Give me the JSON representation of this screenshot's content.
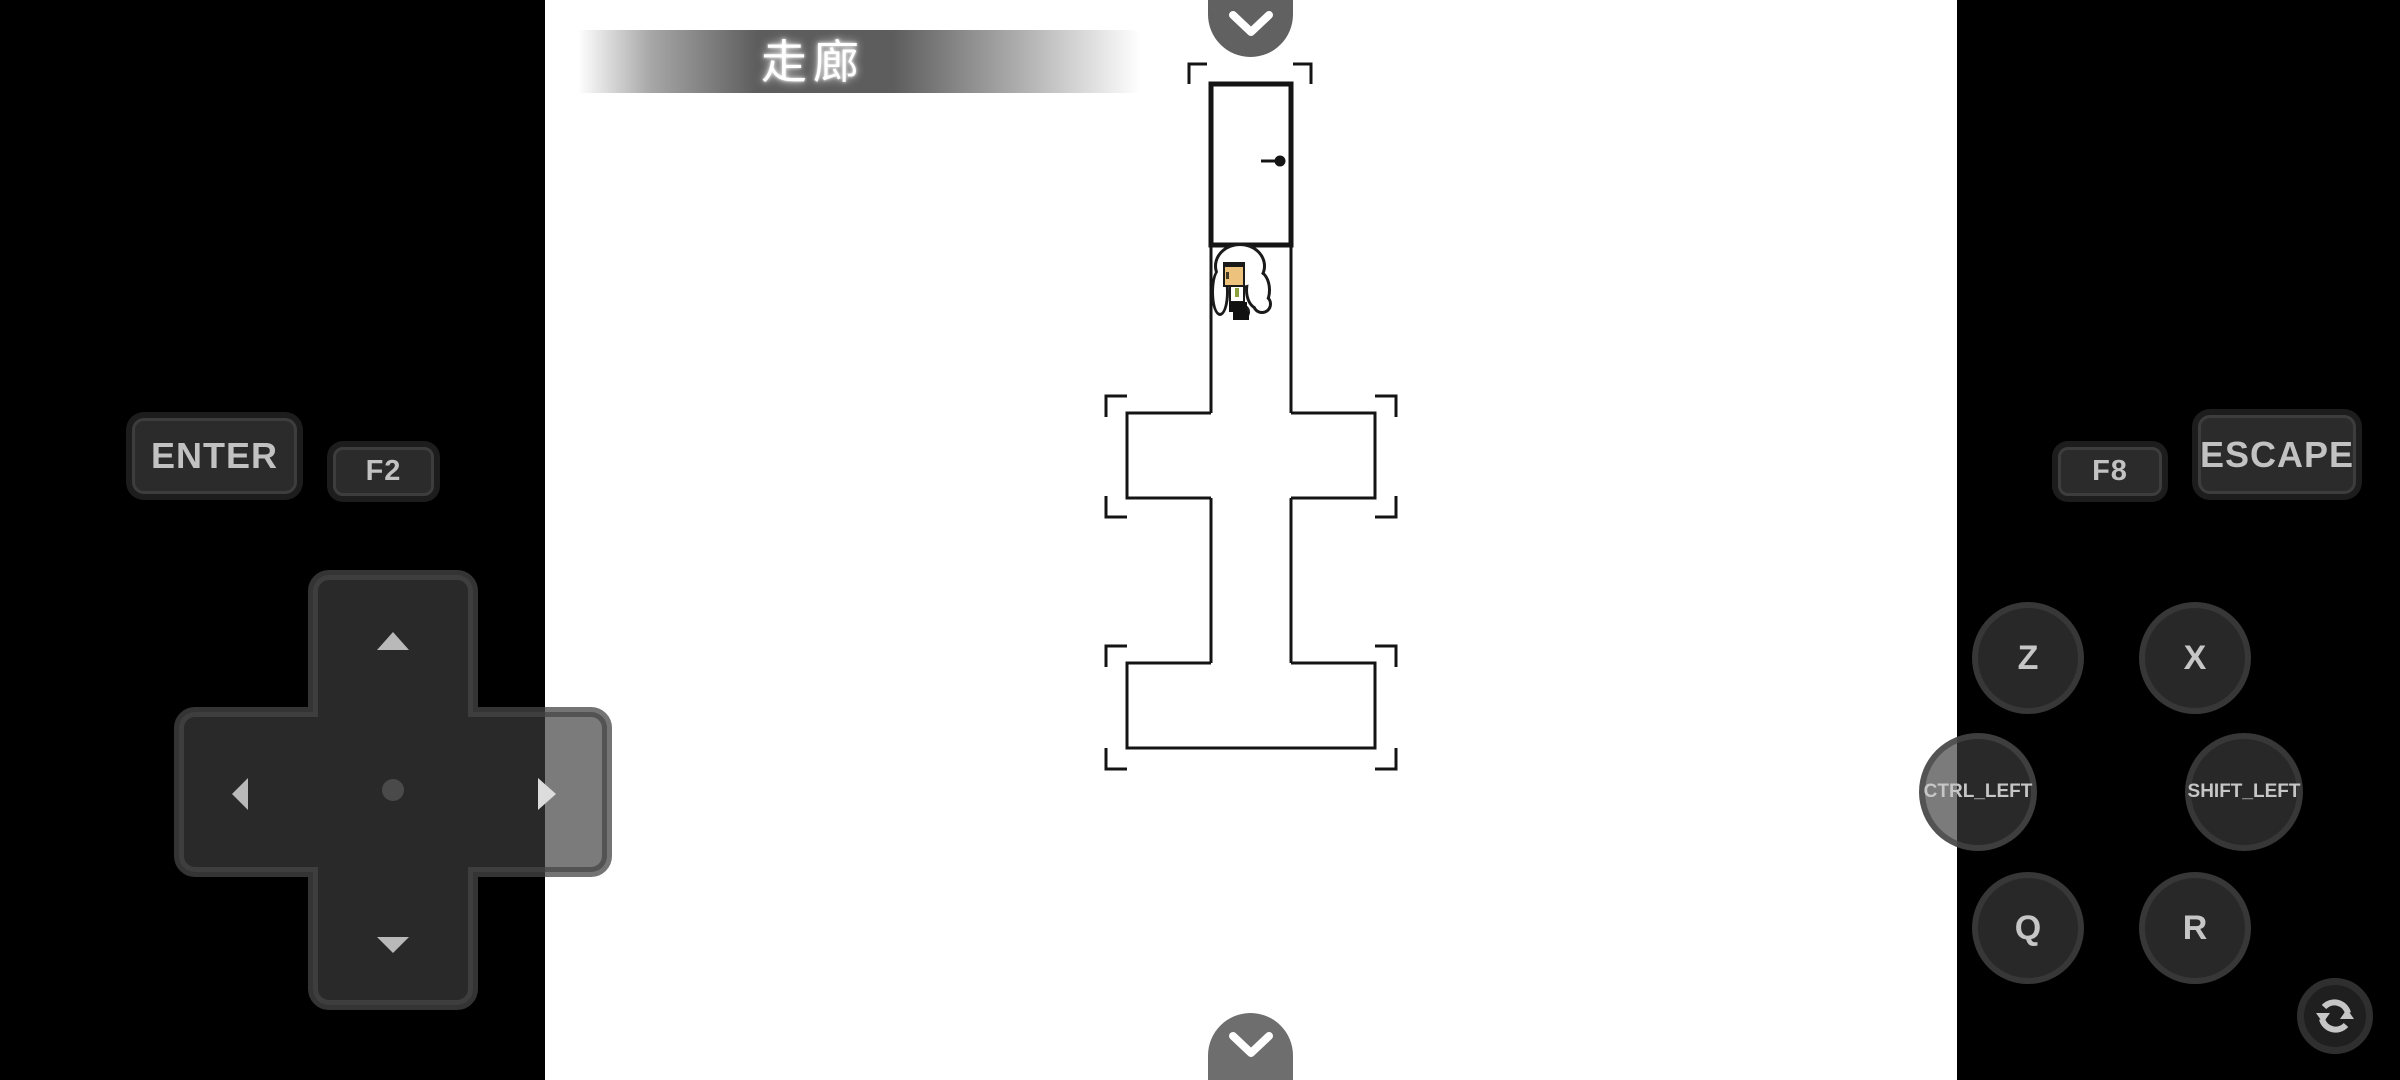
{
  "game": {
    "location_banner": "走廊"
  },
  "controls": {
    "enter": {
      "label": "ENTER"
    },
    "f2": {
      "label": "F2"
    },
    "f8": {
      "label": "F8"
    },
    "escape": {
      "label": "ESCAPE"
    },
    "z": {
      "label": "Z"
    },
    "x": {
      "label": "X"
    },
    "ctrl_left": {
      "label": "CTRL_LEFT"
    },
    "shift_left": {
      "label": "SHIFT_LEFT"
    },
    "q": {
      "label": "Q"
    },
    "r": {
      "label": "R"
    }
  },
  "icons": {
    "top_toggle": "chevron-down",
    "bottom_toggle": "chevron-down",
    "dpad_arrows": [
      "arrow-up",
      "arrow-left",
      "arrow-right",
      "arrow-down"
    ],
    "rotate_button": "rotate-sync"
  },
  "colors": {
    "background": "#000000",
    "game_screen": "#ffffff",
    "map_wall": "#141414",
    "banner_gray": "#4f4f4f",
    "banner_text": "#ffffff",
    "control_fill": "#2b2b2b",
    "control_border": "#3d3d3d",
    "control_text": "#c2c2c2",
    "dome_button_gray": "#6e6e6e",
    "sprite_skin": "#ecc27c",
    "sprite_tie": "#8aa03c"
  }
}
